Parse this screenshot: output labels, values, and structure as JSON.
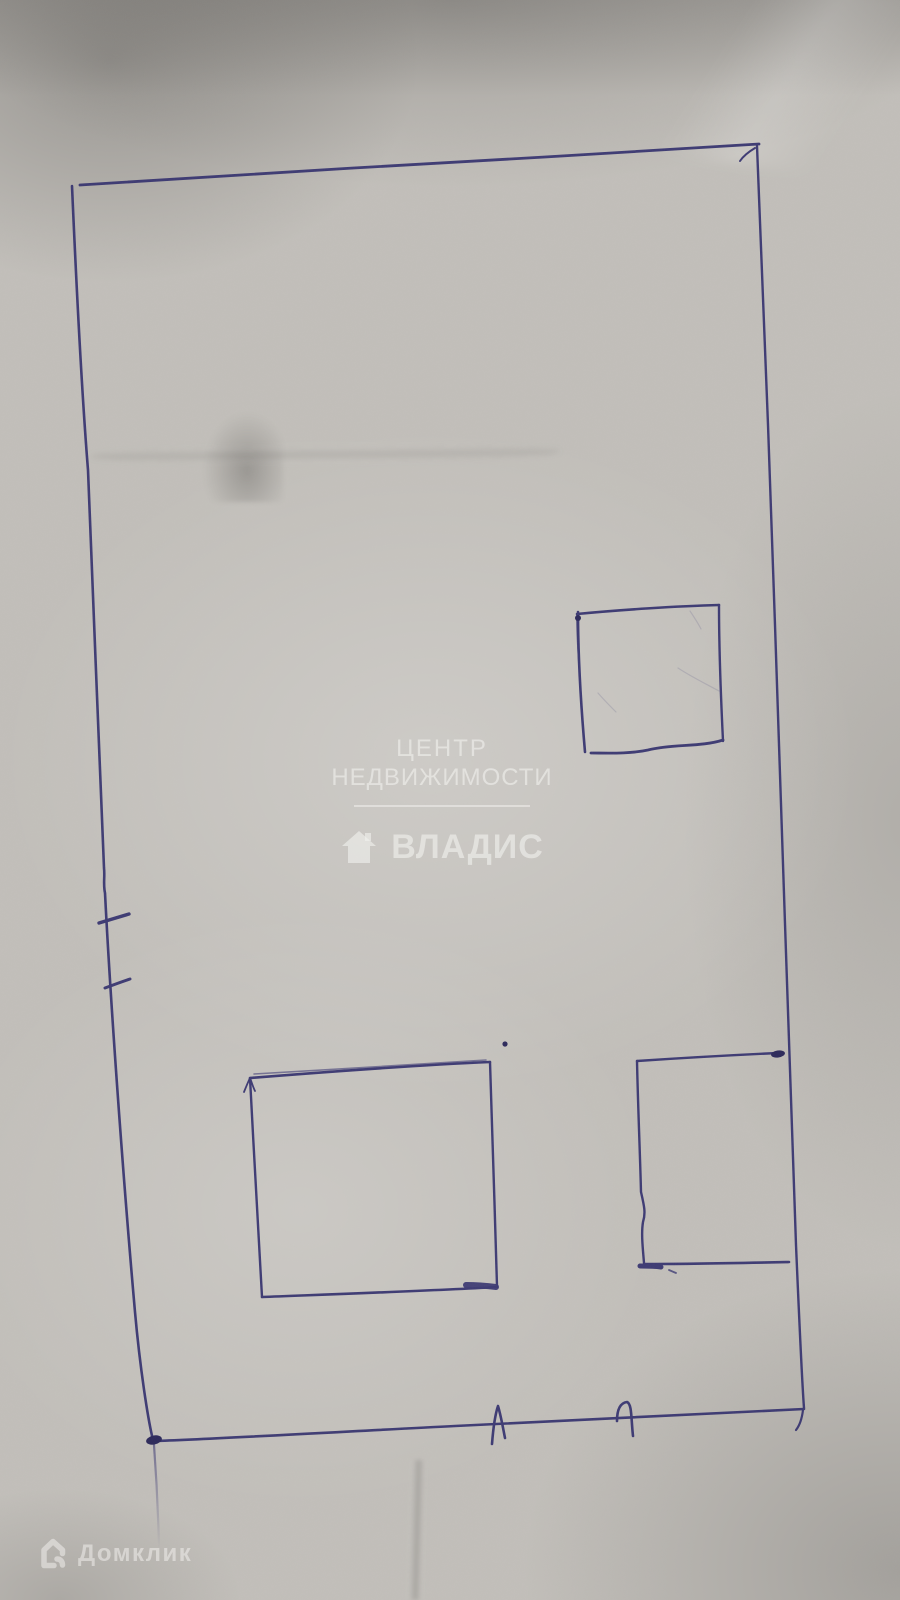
{
  "image": {
    "type": "photo of a hand-drawn floor plan sketch, blue ink on gray paper",
    "paper_color": "#c2bfba"
  },
  "sketch": {
    "ink_color": "#35326f",
    "blob_color": "#232055",
    "content": "Outer rectangular boundary; small square room upper-right; rectangular room lower-left; rectangular room lower-right open to right wall; two tick marks on left wall; two tick marks on bottom wall"
  },
  "watermark": {
    "title_line1": "ЦЕНТР",
    "title_line2": "НЕДВИЖИМОСТИ",
    "brand": "ВЛАДИС",
    "icon": "house-icon",
    "text_color": "rgba(242,241,238,0.60)"
  },
  "footer": {
    "brand": "Домклик",
    "icon": "house-outline-icon",
    "text_color": "rgba(245,244,241,0.50)"
  }
}
